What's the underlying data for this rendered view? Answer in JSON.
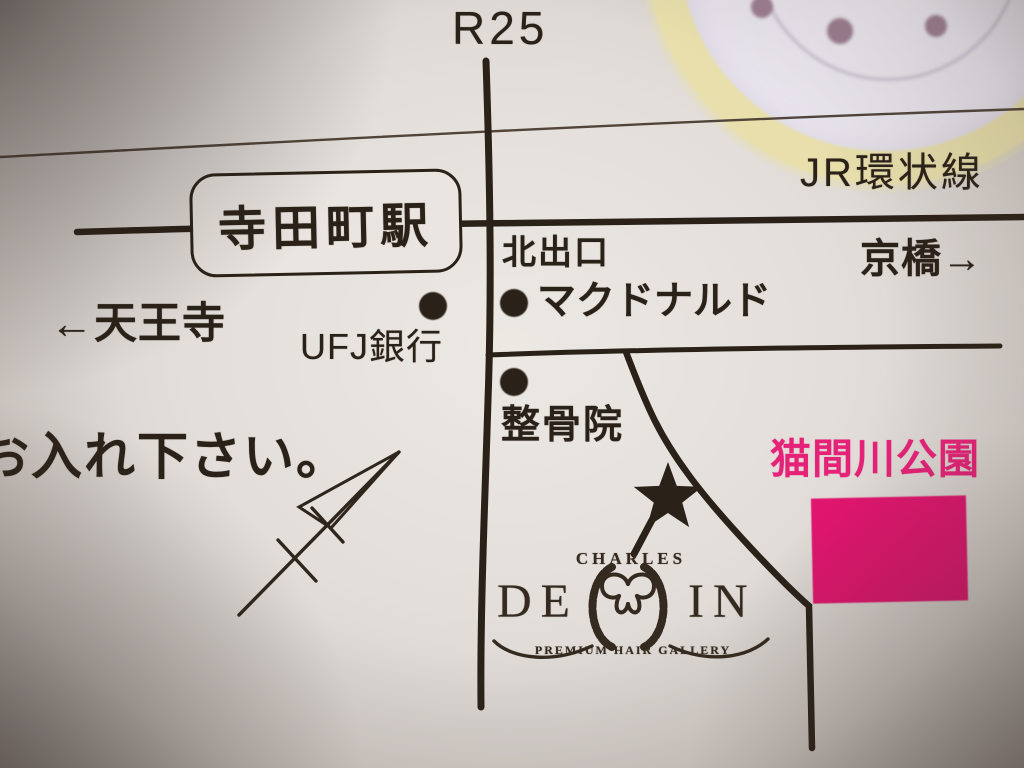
{
  "theme": {
    "ink": "#2a2118",
    "paper": "#eae5e0",
    "park_pink": "#e0156e",
    "park_text_pink": "#e52277",
    "ring_cream": "#e8dfac",
    "plate_dot": "#9c7e91"
  },
  "map": {
    "route_label": "R25",
    "railway": {
      "name": "JR環状線",
      "station": "寺田町駅",
      "exit": "北出口",
      "direction_left": "←天王寺",
      "direction_right": "京橋→"
    },
    "poi": {
      "mcdonalds": "マクドナルド",
      "bank": "UFJ銀行",
      "clinic": "整骨院",
      "park": "猫間川公園"
    },
    "note": "お入れ下さい。"
  },
  "logo": {
    "line1": "CHARLES",
    "left": "DE",
    "right": "IN",
    "tagline": "PREMIUM HAIR GALLERY"
  }
}
